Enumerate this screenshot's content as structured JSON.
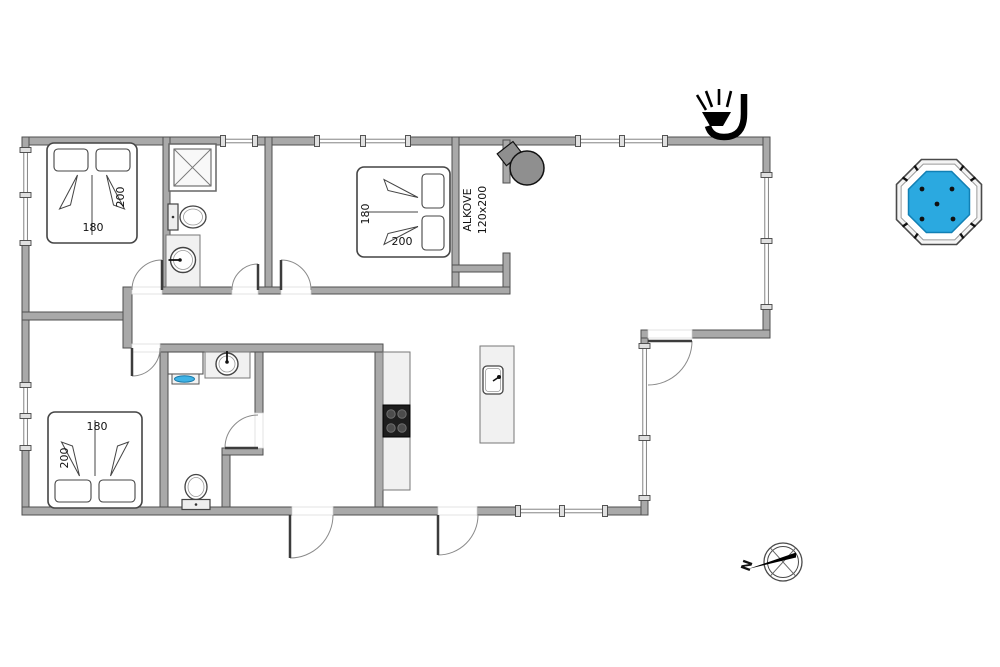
{
  "page": {
    "width": 1000,
    "height": 667,
    "background": "#ffffff"
  },
  "palette": {
    "wall_fill": "#a9a9a9",
    "wall_stroke": "#4f4f4f",
    "fixture_fill": "#f1f1f1",
    "fixture_stroke": "#666666",
    "line": "#3c3c3c",
    "arc": "#8a8a8a",
    "window_fill": "#ffffff",
    "window_cap": "#e0e0e0",
    "text": "#111111",
    "stove_fill": "#8f8f8f",
    "cooktop": "#1d1d1d",
    "burner": "#4c4c4c",
    "tub_rim": "#f4f4f4",
    "tub_water": "#2ba9e0",
    "tub_water_stroke": "#1180b5",
    "sink_blue": "#3fb3e6"
  },
  "floorplan": {
    "walls": [
      {
        "x": 22,
        "y": 137,
        "w": 201,
        "h": 8
      },
      {
        "x": 255,
        "y": 137,
        "w": 62,
        "h": 8
      },
      {
        "x": 408,
        "y": 137,
        "w": 170,
        "h": 8
      },
      {
        "x": 665,
        "y": 137,
        "w": 105,
        "h": 8
      },
      {
        "x": 22,
        "y": 137,
        "w": 7,
        "h": 13
      },
      {
        "x": 22,
        "y": 243,
        "w": 7,
        "h": 142
      },
      {
        "x": 22,
        "y": 448,
        "w": 7,
        "h": 67
      },
      {
        "x": 22,
        "y": 507,
        "w": 270,
        "h": 8
      },
      {
        "x": 333,
        "y": 507,
        "w": 105,
        "h": 8
      },
      {
        "x": 477,
        "y": 507,
        "w": 41,
        "h": 8
      },
      {
        "x": 605,
        "y": 507,
        "w": 43,
        "h": 8
      },
      {
        "x": 763,
        "y": 137,
        "w": 7,
        "h": 38
      },
      {
        "x": 763,
        "y": 307,
        "w": 7,
        "h": 31
      },
      {
        "x": 692,
        "y": 330,
        "w": 78,
        "h": 8
      },
      {
        "x": 641,
        "y": 330,
        "w": 7,
        "h": 8
      },
      {
        "x": 641,
        "y": 338,
        "w": 7,
        "h": 8
      },
      {
        "x": 641,
        "y": 498,
        "w": 7,
        "h": 17
      },
      {
        "x": 163,
        "y": 137,
        "w": 7,
        "h": 157
      },
      {
        "x": 265,
        "y": 137,
        "w": 7,
        "h": 157
      },
      {
        "x": 452,
        "y": 137,
        "w": 7,
        "h": 156
      },
      {
        "x": 503,
        "y": 140,
        "w": 7,
        "h": 43
      },
      {
        "x": 452,
        "y": 265,
        "w": 58,
        "h": 7
      },
      {
        "x": 503,
        "y": 253,
        "w": 7,
        "h": 40
      },
      {
        "x": 162,
        "y": 287,
        "w": 70,
        "h": 7
      },
      {
        "x": 258,
        "y": 287,
        "w": 23,
        "h": 7
      },
      {
        "x": 311,
        "y": 287,
        "w": 199,
        "h": 7
      },
      {
        "x": 123,
        "y": 287,
        "w": 9,
        "h": 61
      },
      {
        "x": 22,
        "y": 312,
        "w": 101,
        "h": 8
      },
      {
        "x": 160,
        "y": 344,
        "w": 223,
        "h": 8
      },
      {
        "x": 160,
        "y": 352,
        "w": 8,
        "h": 155
      },
      {
        "x": 255,
        "y": 352,
        "w": 8,
        "h": 61
      },
      {
        "x": 222,
        "y": 448,
        "w": 41,
        "h": 7
      },
      {
        "x": 222,
        "y": 455,
        "w": 8,
        "h": 52
      },
      {
        "x": 375,
        "y": 352,
        "w": 8,
        "h": 155
      }
    ],
    "windows": [
      {
        "o": "h",
        "x": 223,
        "y": 137,
        "len": 32,
        "caps": [
          0,
          32
        ]
      },
      {
        "o": "h",
        "x": 317,
        "y": 137,
        "len": 91,
        "caps": [
          0,
          46,
          91
        ]
      },
      {
        "o": "h",
        "x": 578,
        "y": 137,
        "len": 87,
        "caps": [
          0,
          44,
          87
        ]
      },
      {
        "o": "h",
        "x": 518,
        "y": 507,
        "len": 87,
        "caps": [
          0,
          44,
          87
        ]
      },
      {
        "o": "v",
        "x": 22,
        "y": 150,
        "len": 93,
        "caps": [
          0,
          45,
          93
        ]
      },
      {
        "o": "v",
        "x": 22,
        "y": 385,
        "len": 63,
        "caps": [
          0,
          31,
          63
        ]
      },
      {
        "o": "v",
        "x": 763,
        "y": 175,
        "len": 132,
        "caps": [
          0,
          66,
          132
        ]
      },
      {
        "o": "v",
        "x": 641,
        "y": 346,
        "len": 152,
        "caps": [
          0,
          92,
          152
        ]
      }
    ],
    "doors": [
      {
        "name": "door-bedroom-1",
        "h": [
          162,
          290
        ],
        "r": 30,
        "leaf": 270,
        "a0": 180,
        "a1": 270,
        "sw": 1,
        "op": [
          132,
          287,
          30,
          7
        ]
      },
      {
        "name": "door-bathroom-1",
        "h": [
          258,
          290
        ],
        "r": 26,
        "leaf": 270,
        "a0": 180,
        "a1": 270,
        "sw": 1,
        "op": [
          232,
          287,
          26,
          7
        ]
      },
      {
        "name": "door-bedroom-2",
        "h": [
          281,
          290
        ],
        "r": 30,
        "leaf": 270,
        "a0": 0,
        "a1": 270,
        "sw": 0,
        "op": [
          281,
          287,
          30,
          7
        ]
      },
      {
        "name": "door-bedroom-3",
        "h": [
          132,
          348
        ],
        "r": 28,
        "leaf": 90,
        "a0": 0,
        "a1": 90,
        "sw": 1,
        "op": [
          132,
          344,
          28,
          8
        ]
      },
      {
        "name": "door-bathroom-2",
        "h": [
          258,
          448
        ],
        "r": 33,
        "leaf": 180,
        "a0": 270,
        "a1": 180,
        "sw": 0,
        "op": [
          255,
          413,
          8,
          35
        ]
      },
      {
        "name": "door-entrance",
        "h": [
          290,
          515
        ],
        "r": 43,
        "leaf": 90,
        "a0": 0,
        "a1": 90,
        "sw": 1,
        "op": [
          292,
          507,
          41,
          8
        ]
      },
      {
        "name": "door-terrace-south",
        "h": [
          438,
          515
        ],
        "r": 40,
        "leaf": 90,
        "a0": 0,
        "a1": 90,
        "sw": 1,
        "op": [
          438,
          507,
          39,
          8
        ]
      },
      {
        "name": "door-terrace-east",
        "h": [
          648,
          341
        ],
        "r": 44,
        "leaf": 0,
        "a0": 0,
        "a1": 90,
        "sw": 1,
        "op": [
          648,
          330,
          44,
          8
        ]
      }
    ],
    "beds": [
      {
        "name": "double-bed-1",
        "w": 90,
        "h": 100,
        "transform": "translate(47,143)"
      },
      {
        "name": "double-bed-2",
        "w": 90,
        "h": 93,
        "transform": "translate(450,167) rotate(90)"
      },
      {
        "name": "double-bed-3",
        "w": 94,
        "h": 96,
        "transform": "translate(142,508) rotate(180)"
      }
    ],
    "fixtures": [
      {
        "type": "shower",
        "name": "shower-cabin",
        "x": 169,
        "y": 144,
        "size": 47
      },
      {
        "type": "toilet",
        "name": "toilet-bathroom-1",
        "cx": 193,
        "cy": 217,
        "dir": "e"
      },
      {
        "type": "toilet",
        "name": "toilet-bathroom-2",
        "cx": 196,
        "cy": 487,
        "dir": "n"
      },
      {
        "type": "washbasin",
        "name": "washbasin-bathroom-1",
        "x": 166,
        "y": 235,
        "w": 34,
        "h": 52,
        "cx": 183,
        "cy": 260,
        "r": 12.5,
        "faucet": "w"
      },
      {
        "type": "washbasin",
        "name": "washbasin-bathroom-2",
        "x": 205,
        "y": 352,
        "w": 45,
        "h": 26,
        "cx": 227,
        "cy": 364,
        "r": 11,
        "faucet": "n"
      },
      {
        "type": "vanity",
        "name": "vanity-sink",
        "x": 168,
        "y": 352,
        "w": 35,
        "h": 22
      },
      {
        "type": "kitchencounter",
        "name": "kitchen-counter-cooktop",
        "x": 383,
        "y": 352,
        "w": 27,
        "h": 138,
        "cty": 405,
        "cth": 32
      },
      {
        "type": "island",
        "name": "kitchen-island-sink",
        "x": 480,
        "y": 346,
        "w": 34,
        "h": 97
      },
      {
        "type": "stove",
        "name": "wood-stove",
        "cx": 527,
        "cy": 168,
        "r": 17
      },
      {
        "type": "hottub",
        "name": "hot-tub",
        "cx": 939,
        "cy": 202,
        "ro": 46,
        "rm": 41,
        "rw": 33
      },
      {
        "type": "lamp",
        "name": "outdoor-lamp-icon"
      },
      {
        "type": "compass",
        "name": "compass-rose",
        "cx": 783,
        "cy": 562,
        "r": 19
      }
    ],
    "texts": [
      {
        "t": "200",
        "x": 124,
        "y": 197,
        "rot": -90,
        "name": "bed1-length-label"
      },
      {
        "t": "180",
        "x": 93,
        "y": 231,
        "rot": 0,
        "name": "bed1-width-label"
      },
      {
        "t": "180",
        "x": 369,
        "y": 214,
        "rot": -90,
        "name": "bed2-width-label"
      },
      {
        "t": "200",
        "x": 402,
        "y": 245,
        "rot": 0,
        "name": "bed2-length-label"
      },
      {
        "t": "180",
        "x": 97,
        "y": 430,
        "rot": 0,
        "name": "bed3-width-label"
      },
      {
        "t": "200",
        "x": 68,
        "y": 458,
        "rot": -90,
        "name": "bed3-length-label"
      },
      {
        "t": "ALKOVE",
        "x": 471,
        "y": 210,
        "rot": -90,
        "name": "alcove-label"
      },
      {
        "t": "120x200",
        "x": 486,
        "y": 210,
        "rot": -90,
        "name": "alcove-size-label"
      },
      {
        "t": "N",
        "x": 751,
        "y": 567,
        "rot": -70,
        "size": 13,
        "bold": true,
        "name": "compass-north-label"
      }
    ]
  }
}
